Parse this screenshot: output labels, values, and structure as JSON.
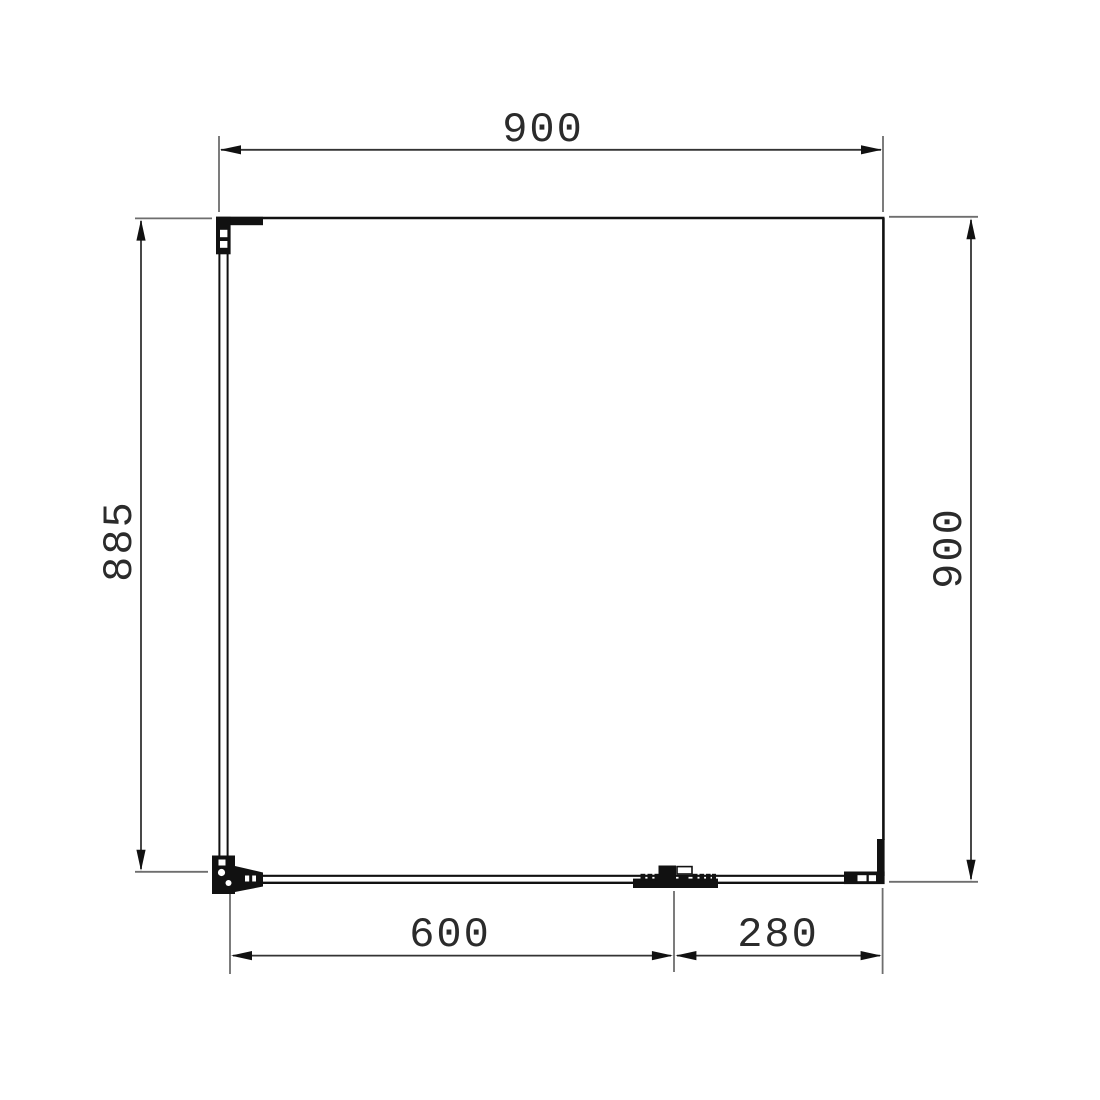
{
  "drawing": {
    "title": "shower-enclosure-plan-view",
    "dimensions": {
      "top_width": "900",
      "left_height": "885",
      "right_height": "900",
      "bottom_door_width": "600",
      "bottom_panel_width": "280"
    },
    "colors": {
      "outline": "#111111",
      "dimension_line": "#333333",
      "extension_line": "#6e6e6e",
      "text": "#2b2b2b",
      "background": "#ffffff"
    }
  }
}
